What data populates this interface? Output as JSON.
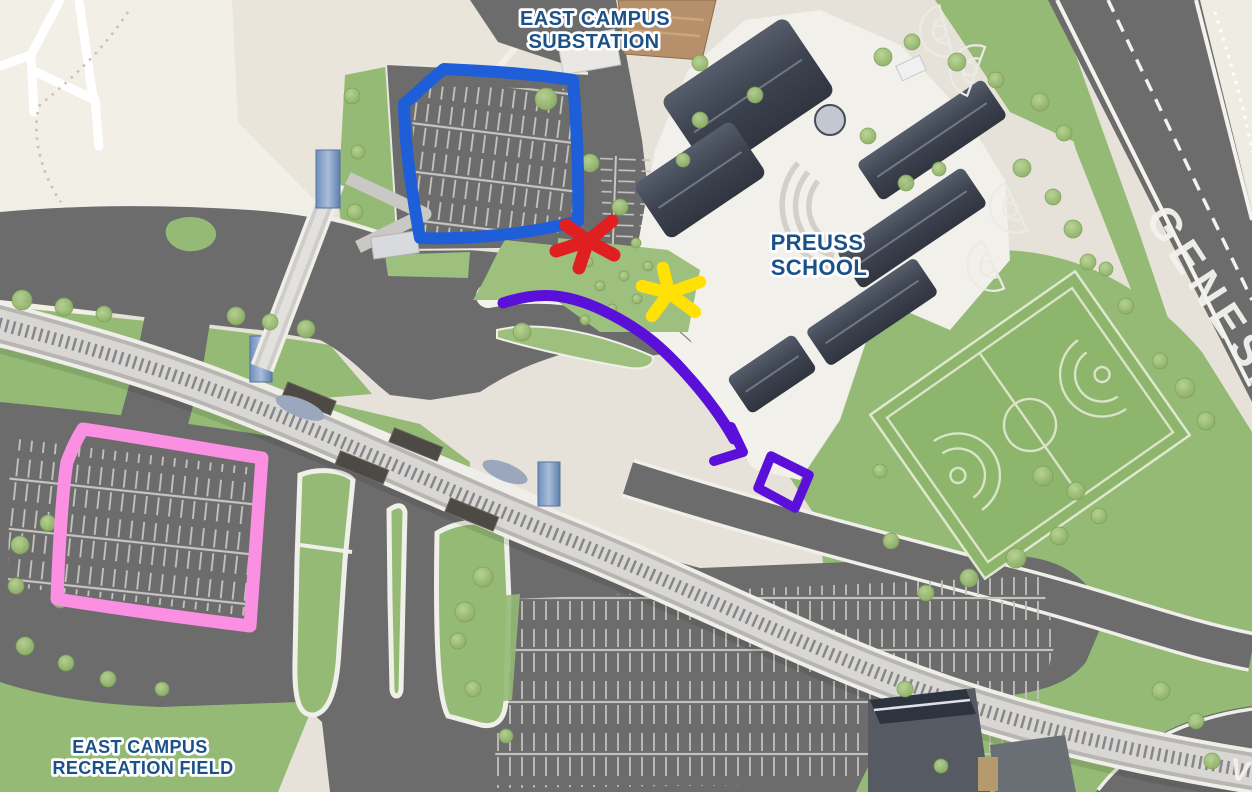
{
  "canvas": {
    "width": 1252,
    "height": 792,
    "type": "annotated-3d-campus-map"
  },
  "labels": {
    "substation": {
      "lines": [
        "EAST CAMPUS",
        "SUBSTATION"
      ],
      "color": "#1b5189"
    },
    "preuss": {
      "lines": [
        "PREUSS",
        "SCHOOL"
      ],
      "color": "#1b5189"
    },
    "recreation": {
      "lines": [
        "EAST CAMPUS",
        "RECREATION FIELD"
      ],
      "color": "#1b5189"
    },
    "genesee": {
      "text": "GENESE",
      "color": "#f3f2ee"
    },
    "voigt": {
      "text": "V",
      "color": "#f3f2ee"
    }
  },
  "annotations": {
    "blue_rectangle": {
      "shape": "rectangle-outline",
      "color": "#1e5ed8"
    },
    "pink_rectangle": {
      "shape": "rectangle-outline",
      "color": "#fb8fe2"
    },
    "purple_route": {
      "shape": "curved-arrow",
      "color": "#5a10d8"
    },
    "purple_small_rectangle": {
      "shape": "rectangle-outline",
      "color": "#5a10d8"
    },
    "red_asterisk": {
      "shape": "asterisk",
      "color": "#e02020"
    },
    "yellow_asterisk": {
      "shape": "asterisk",
      "color": "#ffe106"
    }
  },
  "palette": {
    "road": "#6c6c6c",
    "grass": "#94ba75",
    "sports_field": "#8db56c",
    "flat_map": "#f2efe6",
    "base": "#e6e2d9",
    "pavement": "#f2f0ea",
    "rail": "#d8d7d3",
    "building_roof": "#454b57",
    "canopy": "#4d4944"
  }
}
